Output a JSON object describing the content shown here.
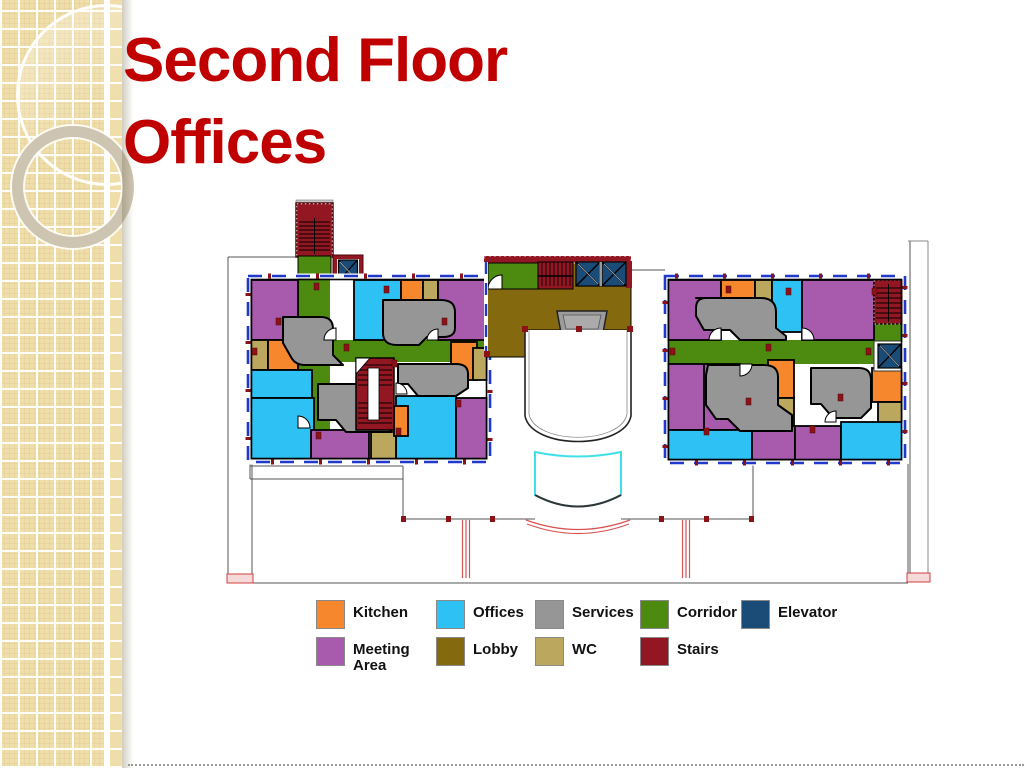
{
  "theme": {
    "background": "#FFFFFF",
    "accent_red": "#C00000",
    "sidebar_tile": "#EFDEA9",
    "window_blue": "#2138CC",
    "wall_black": "#000000"
  },
  "slide": {
    "title_line1": "Second Floor",
    "title_line2": "Offices"
  },
  "legend": {
    "items": [
      {
        "id": "kitchen",
        "label": "Kitchen",
        "color": "#F6872C"
      },
      {
        "id": "offices",
        "label": "Offices",
        "color": "#2EC1F4"
      },
      {
        "id": "services",
        "label": "Services",
        "color": "#969696"
      },
      {
        "id": "corridor",
        "label": "Corridor",
        "color": "#4D8B10"
      },
      {
        "id": "elevator",
        "label": "Elevator",
        "color": "#1B4B77"
      },
      {
        "id": "meeting-area",
        "label": "Meeting Area",
        "color": "#A85BAC"
      },
      {
        "id": "lobby",
        "label": "Lobby",
        "color": "#85690E"
      },
      {
        "id": "wc",
        "label": "WC",
        "color": "#BCA75F"
      },
      {
        "id": "stairs",
        "label": "Stairs",
        "color": "#921722"
      }
    ]
  }
}
